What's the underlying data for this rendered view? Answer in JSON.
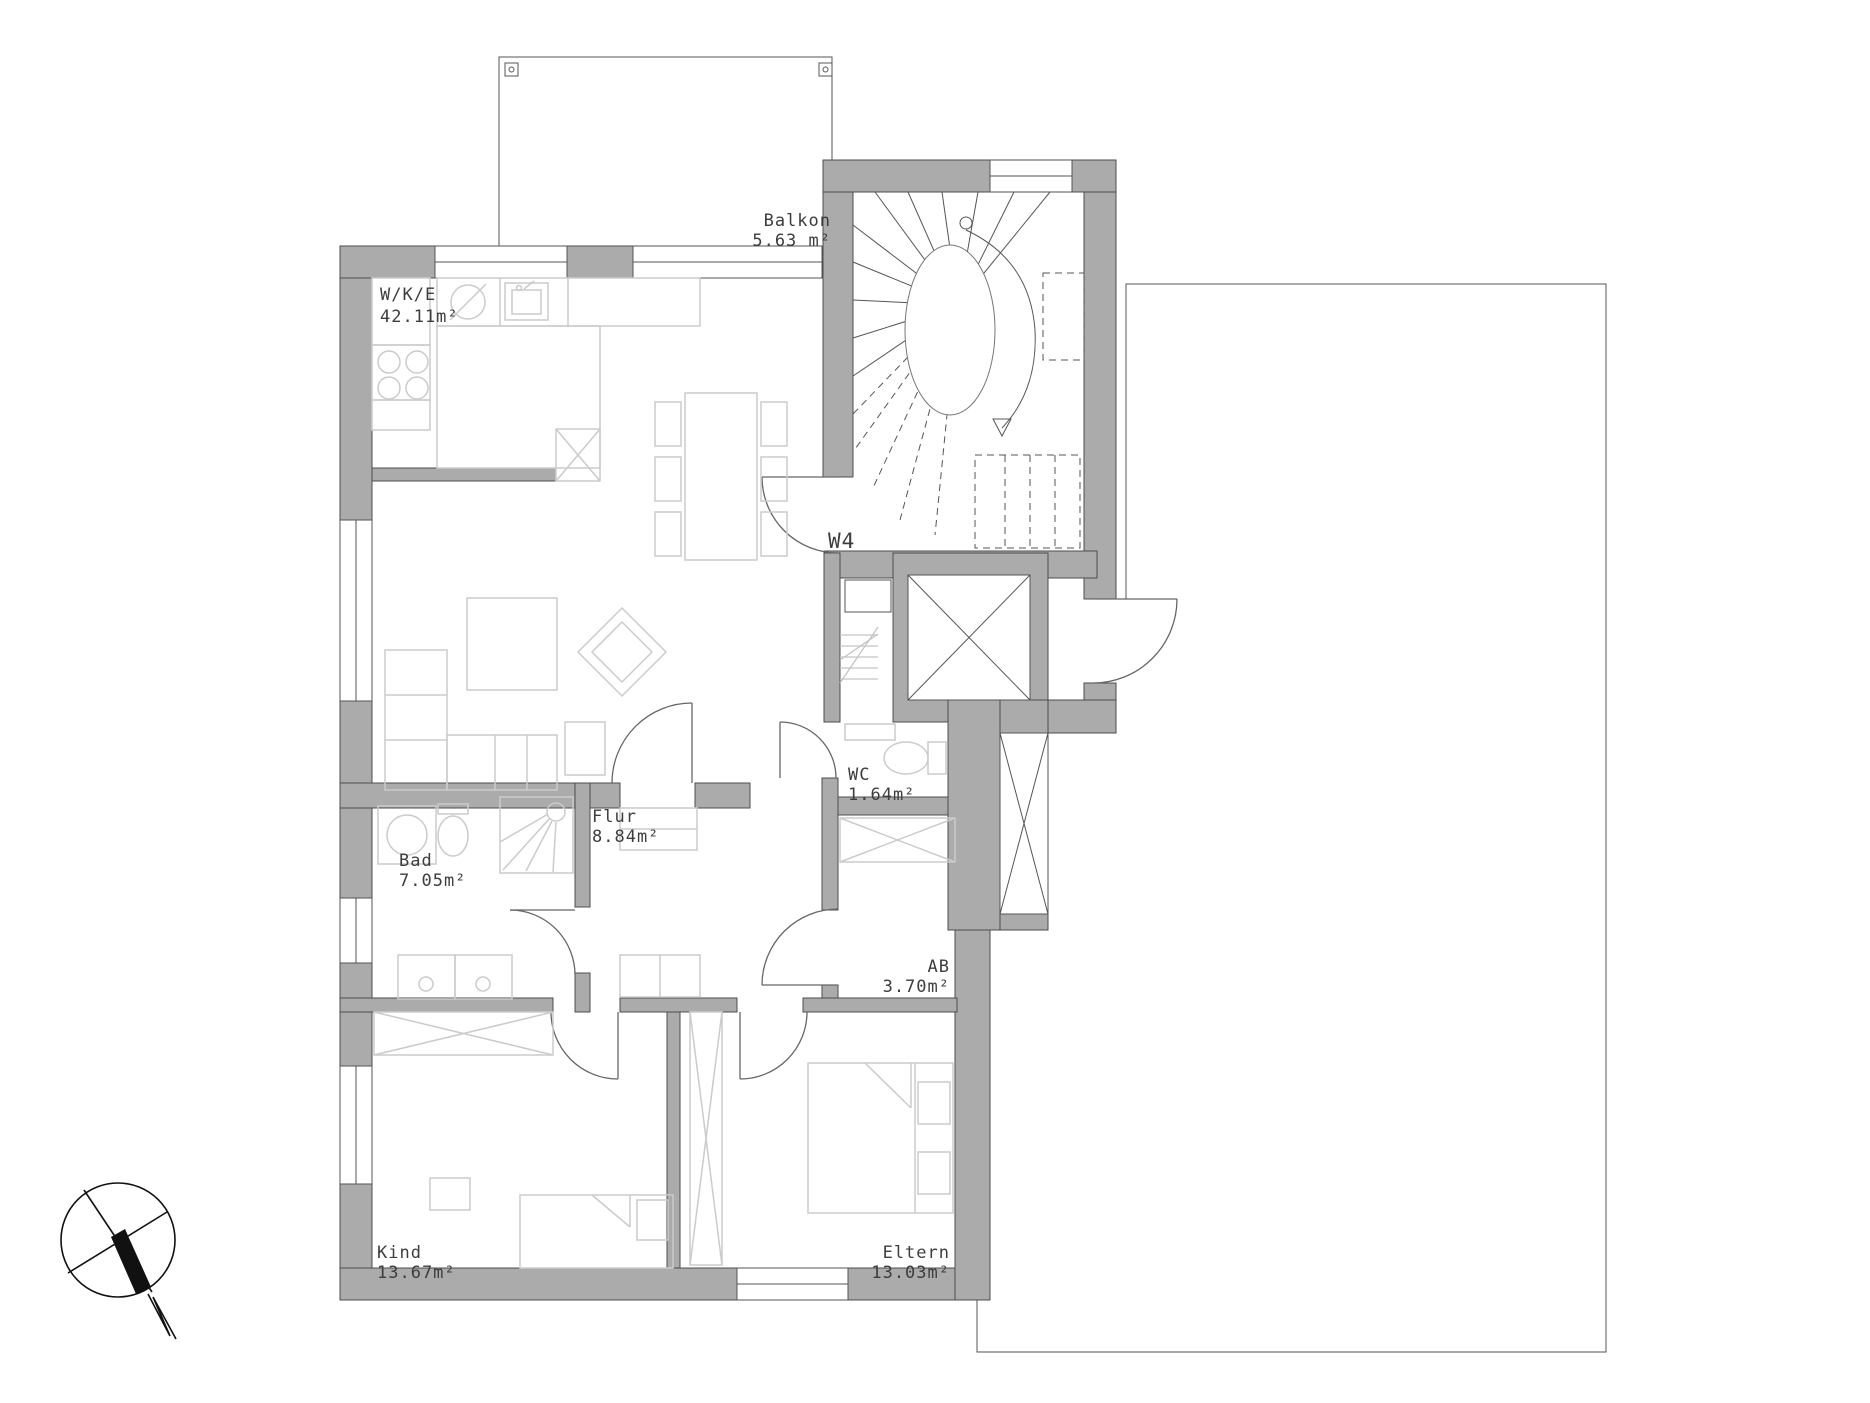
{
  "title": {
    "unit_label": "W4"
  },
  "rooms": {
    "balkon": {
      "name": "Balkon",
      "area": "5.63 m²"
    },
    "wke": {
      "name": "W/K/E",
      "area": "42.11m²"
    },
    "wc": {
      "name": "WC",
      "area": "1.64m²"
    },
    "flur": {
      "name": "Flur",
      "area": "8.84m²"
    },
    "bad": {
      "name": "Bad",
      "area": "7.05m²"
    },
    "ab": {
      "name": "AB",
      "area": "3.70m²"
    },
    "kind": {
      "name": "Kind",
      "area": "13.67m²"
    },
    "eltern": {
      "name": "Eltern",
      "area": "13.03m²"
    }
  },
  "colors": {
    "wall_fill": "#ababab",
    "wall_stroke": "#4d4d4d",
    "thin_line": "#555555",
    "furniture_line": "#cbcbcb",
    "text_color": "#3d3d3d",
    "background": "#ffffff"
  },
  "icons": {
    "compass": "north-arrow-compass"
  }
}
